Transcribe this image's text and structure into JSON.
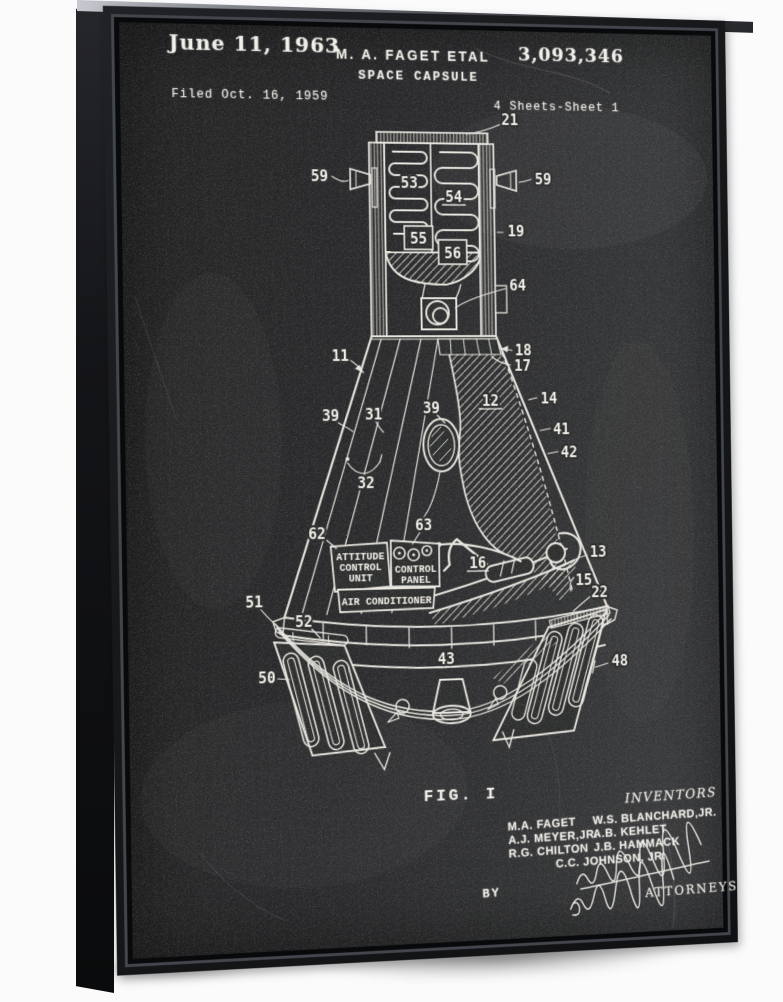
{
  "header": {
    "date": "June 11, 1963",
    "author": "M. A. FAGET ETAL",
    "patent_number": "3,093,346",
    "title": "SPACE CAPSULE",
    "filed": "Filed Oct. 16, 1959",
    "sheet_info": "4 Sheets-Sheet 1"
  },
  "figure": {
    "label": "FIG. I"
  },
  "boxes": {
    "attitude": [
      "ATTITUDE",
      "CONTROL",
      "UNIT"
    ],
    "control": [
      "CONTROL",
      "PANEL"
    ],
    "air": "AIR CONDITIONER"
  },
  "refs": {
    "r11": "11",
    "r12": "12",
    "r13": "13",
    "r14": "14",
    "r15": "15",
    "r16": "16",
    "r17": "17",
    "r18": "18",
    "r19": "19",
    "r21": "21",
    "r22": "22",
    "r31": "31",
    "r32": "32",
    "r39": "39",
    "r41": "41",
    "r42": "42",
    "r43": "43",
    "r48": "48",
    "r50": "50",
    "r51": "51",
    "r52": "52",
    "r53": "53",
    "r54": "54",
    "r55": "55",
    "r56": "56",
    "r59": "59",
    "r62": "62",
    "r63": "63",
    "r64": "64"
  },
  "footer": {
    "inventors_heading": "INVENTORS",
    "col1": [
      "M.A. FAGET",
      "A.J. MEYER,JR.",
      "R.G. CHILTON"
    ],
    "col2": [
      "W.S. BLANCHARD,JR.",
      "A.B. KEHLET",
      "J.B. HAMMACK"
    ],
    "last_inventor": "C.C. JOHNSON, JR.",
    "by_label": "BY",
    "attorneys_label": "ATTORNEYS"
  },
  "colors": {
    "frame": "#17181a",
    "canvas": "#2b2c2c",
    "chalk": "#e9e7e0",
    "background": "#fbfbfc"
  }
}
